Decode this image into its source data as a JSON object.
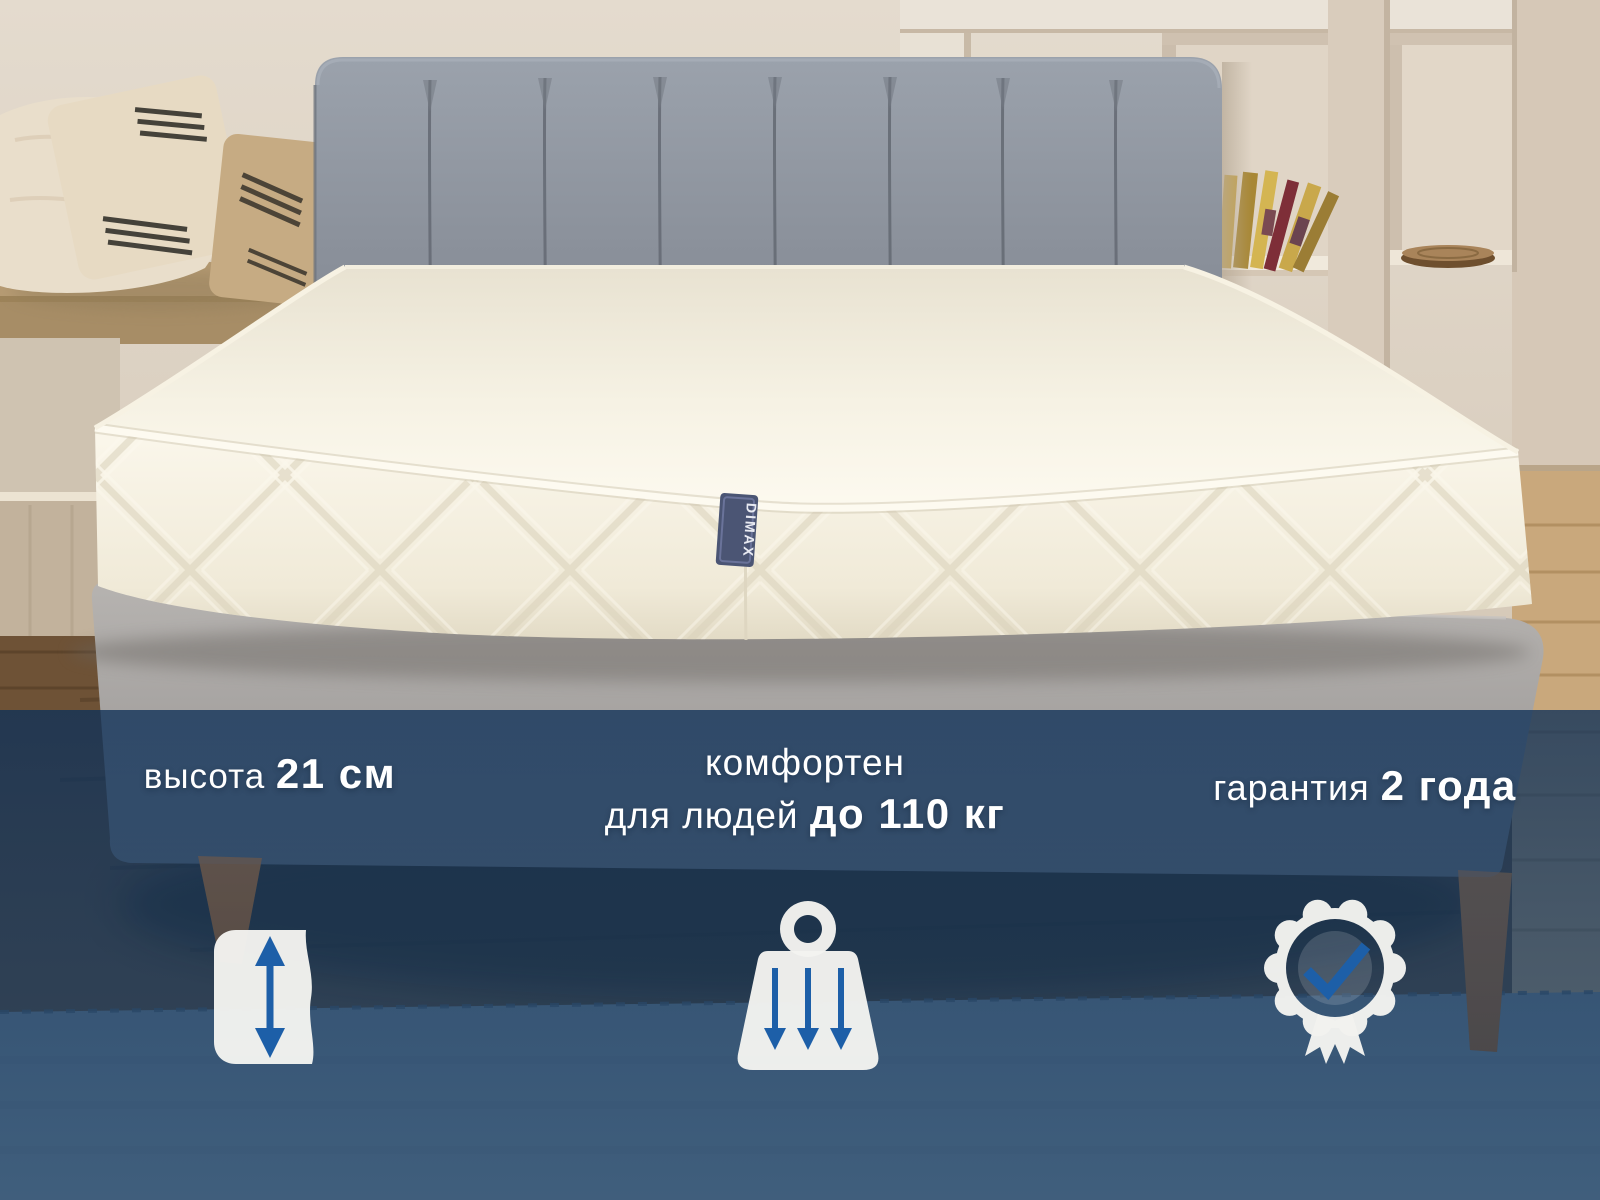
{
  "infographic": {
    "items": [
      {
        "icon": "mattress-height-icon",
        "text_prefix": "высота ",
        "text_value": "21 см"
      },
      {
        "icon": "max-weight-icon",
        "line1": "комфортен",
        "line2_prefix": "для людей ",
        "line2_value": "до 110 кг"
      },
      {
        "icon": "warranty-badge-icon",
        "text_prefix": "гарантия ",
        "text_value": "2 года"
      }
    ]
  },
  "brand_tag": {
    "label": "DIMAX"
  },
  "colors": {
    "overlay_navy": "#14344F",
    "accent_blue": "#1D5FA8",
    "caption_text": "#FFFFFF",
    "mattress_white": "#FAF6EA",
    "headboard_gray": "#8B919B"
  }
}
